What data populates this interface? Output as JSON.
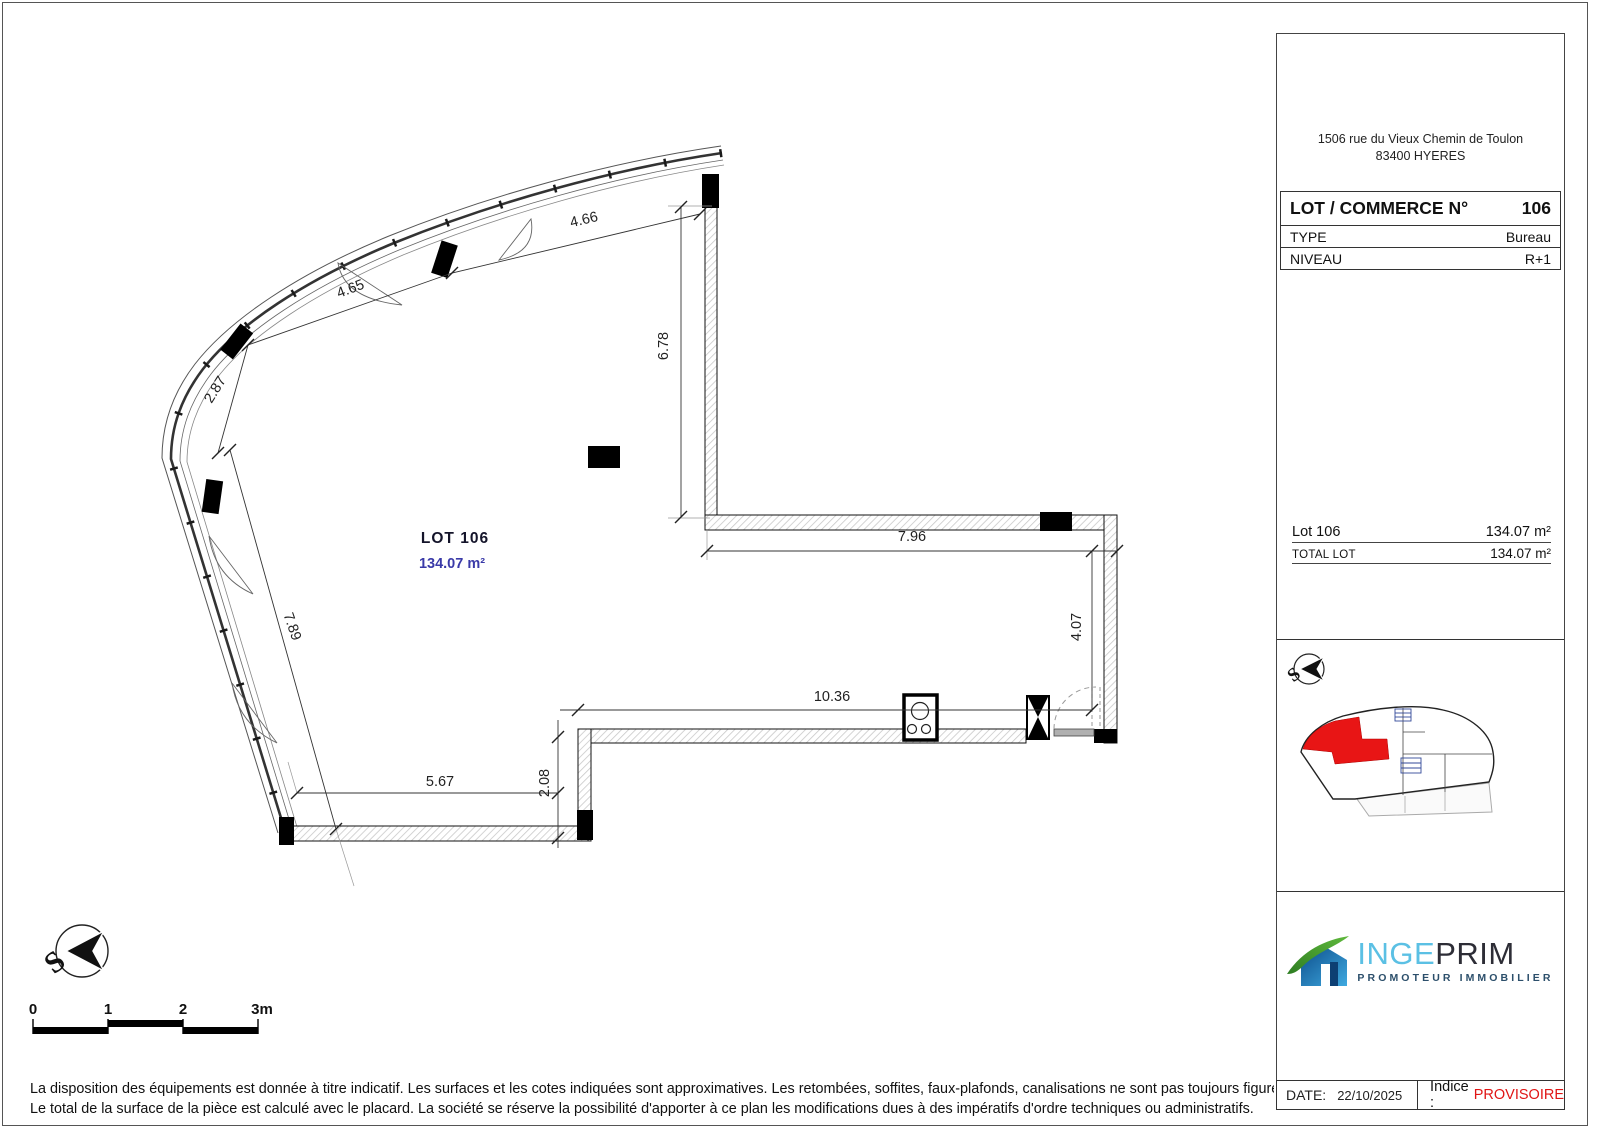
{
  "plan": {
    "lot_label": "LOT 106",
    "area_label": "134.07 m²",
    "dims": {
      "facade1": "4.66",
      "facade2": "4.65",
      "facade3": "2.87",
      "left_wall": "7.89",
      "bottom_left": "5.67",
      "step": "2.08",
      "bottom": "10.36",
      "inner_width": "7.96",
      "inner_right": "4.07",
      "right_wall": "6.78"
    }
  },
  "compass": {
    "letter": "S"
  },
  "scalebar": {
    "labels": [
      "0",
      "1",
      "2",
      "3m"
    ]
  },
  "sidebar": {
    "address_line1": "1506 rue du Vieux Chemin de Toulon",
    "address_line2": "83400 HYERES",
    "lot_table": {
      "title": "LOT / COMMERCE N°",
      "number": "106",
      "type_label": "TYPE",
      "type_value": "Bureau",
      "level_label": "NIVEAU",
      "level_value": "R+1"
    },
    "areas": {
      "rows": [
        {
          "label": "Lot 106",
          "value": "134.07 m²"
        },
        {
          "label": "TOTAL LOT",
          "value": "134.07 m²"
        }
      ]
    },
    "logo": {
      "name_part1": "INGE",
      "name_part2": "PRIM",
      "subtitle": "PROMOTEUR IMMOBILIER"
    },
    "footer": {
      "date_label": "DATE:",
      "date_value": "22/10/2025",
      "indice_label": "Indice :",
      "indice_value": "PROVISOIRE"
    }
  },
  "disclaimer": {
    "line1": "La disposition des équipements est donnée à titre indicatif. Les surfaces et les cotes indiquées sont approximatives. Les retombées, soffites, faux-plafonds, canalisations ne sont pas toujours figurés sur ce plan.",
    "line2": "Le total de la surface de la pièce est calculé avec le placard. La société se réserve la possibilité d'apporter à ce plan les modifications dues à des impératifs d'ordre techniques ou administratifs."
  },
  "colors": {
    "lot_area_blue": "#3a3aa8",
    "indice_red": "#e01515",
    "lot_highlight_red": "#e81515",
    "logo_blue": "#5bc0e4",
    "logo_dark": "#2d2d36",
    "logo_green": "#3e9430",
    "logo_navy": "#2c4f6b"
  }
}
